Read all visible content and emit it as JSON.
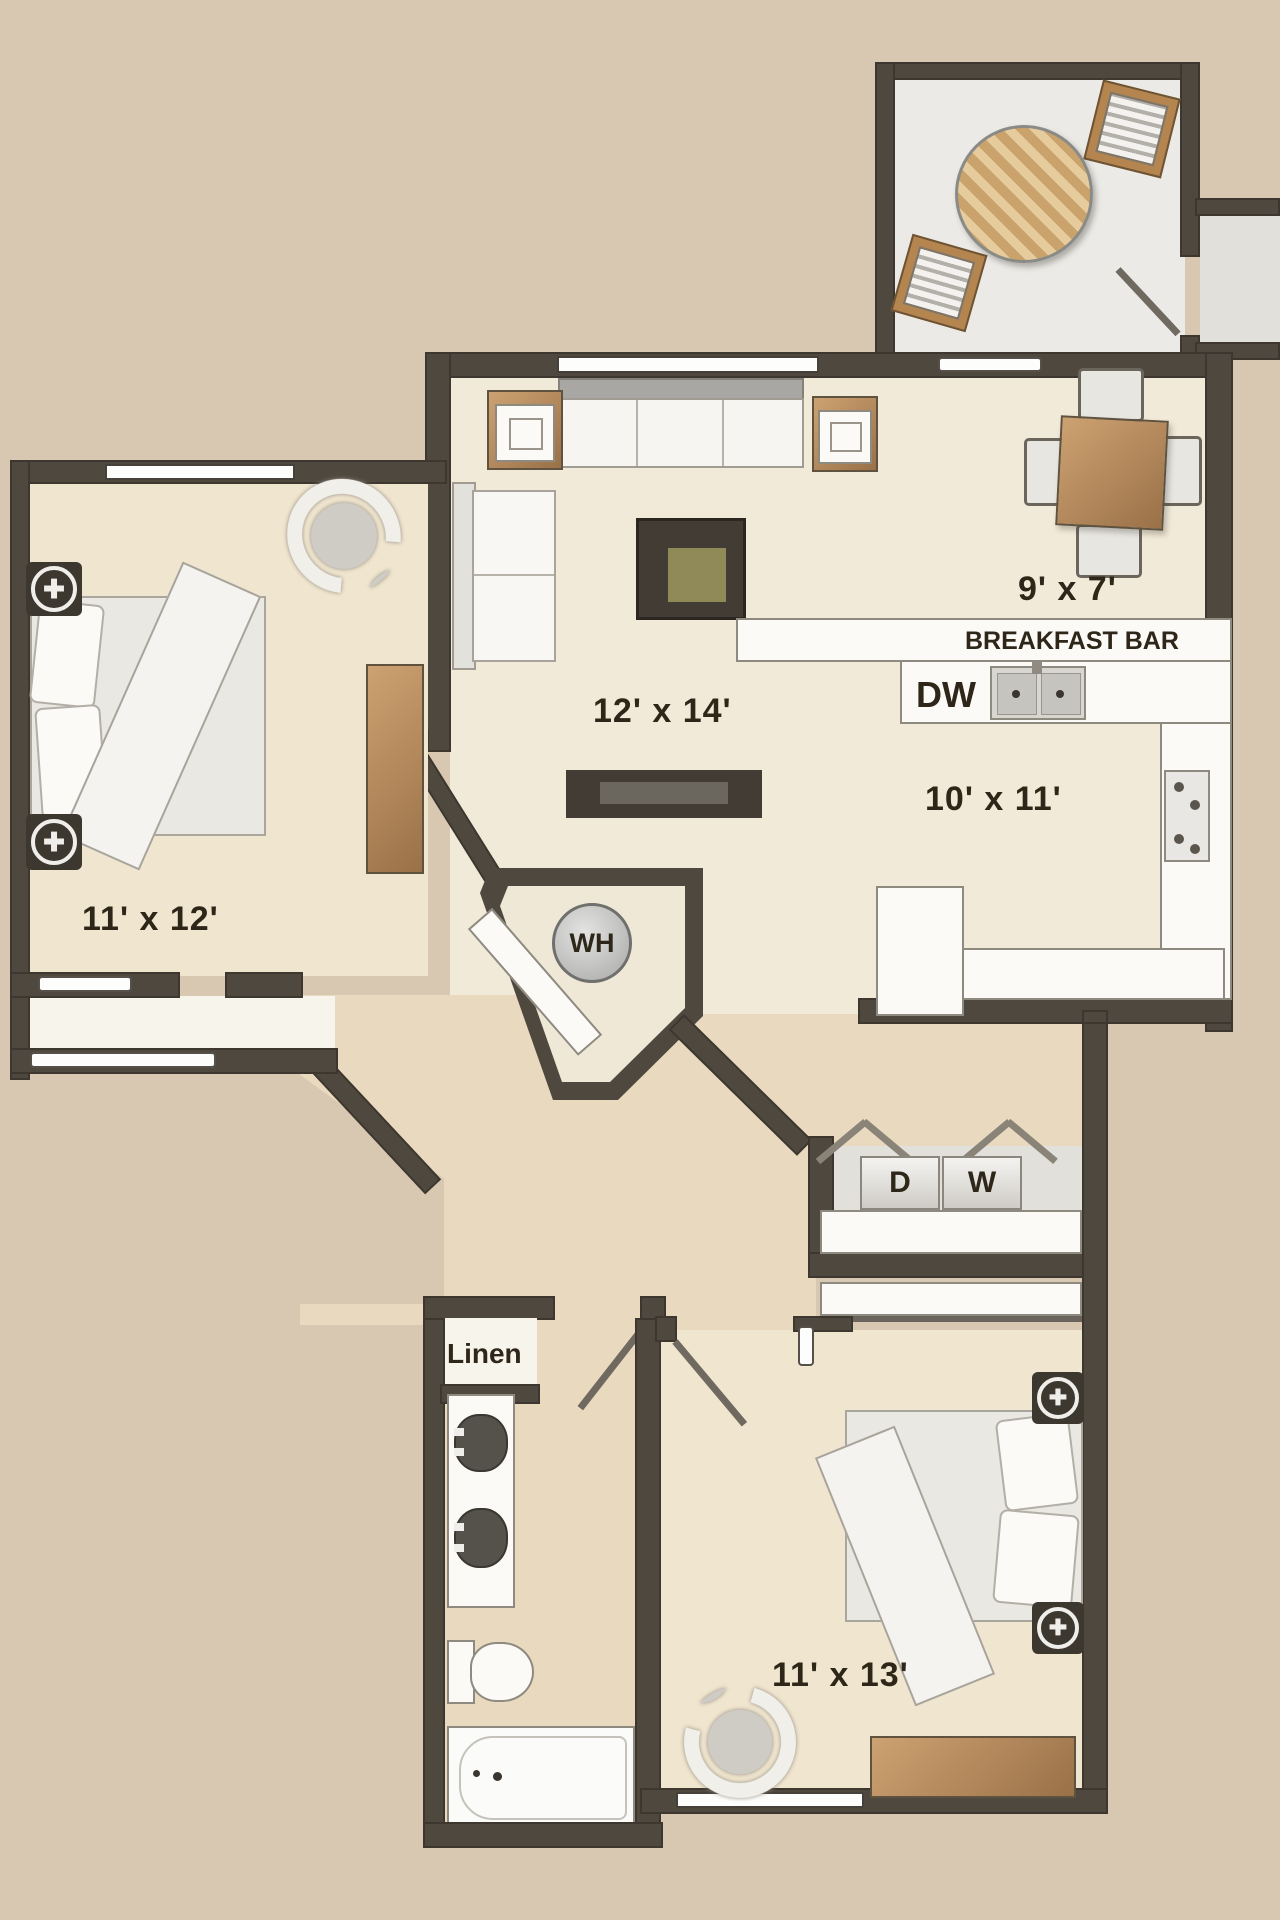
{
  "title": "2 bedroom apartment floor plan",
  "colors": {
    "background": "#d9c8b1",
    "wall": "#4f483e",
    "floor_living": "#f2ead8",
    "floor_bedroom": "#f0e5ce",
    "floor_hall": "#e9dabf",
    "floor_patio": "#ebeae6",
    "fixture_white": "#fbfaf6",
    "wood": "#b08354",
    "label_text": "#2e2619"
  },
  "rooms": {
    "living": {
      "dims": "12' x 14'"
    },
    "dining": {
      "dims": "9' x 7'"
    },
    "kitchen": {
      "dims": "10' x 11'",
      "breakfast_bar": "BREAKFAST BAR",
      "dishwasher": "DW"
    },
    "bedroom1": {
      "dims": "11' x 12'"
    },
    "bedroom2": {
      "dims": "11' x 13'"
    },
    "bathroom": {
      "linen_closet": "Linen"
    },
    "utility": {
      "water_heater": "WH",
      "dryer": "D",
      "washer": "W"
    }
  }
}
